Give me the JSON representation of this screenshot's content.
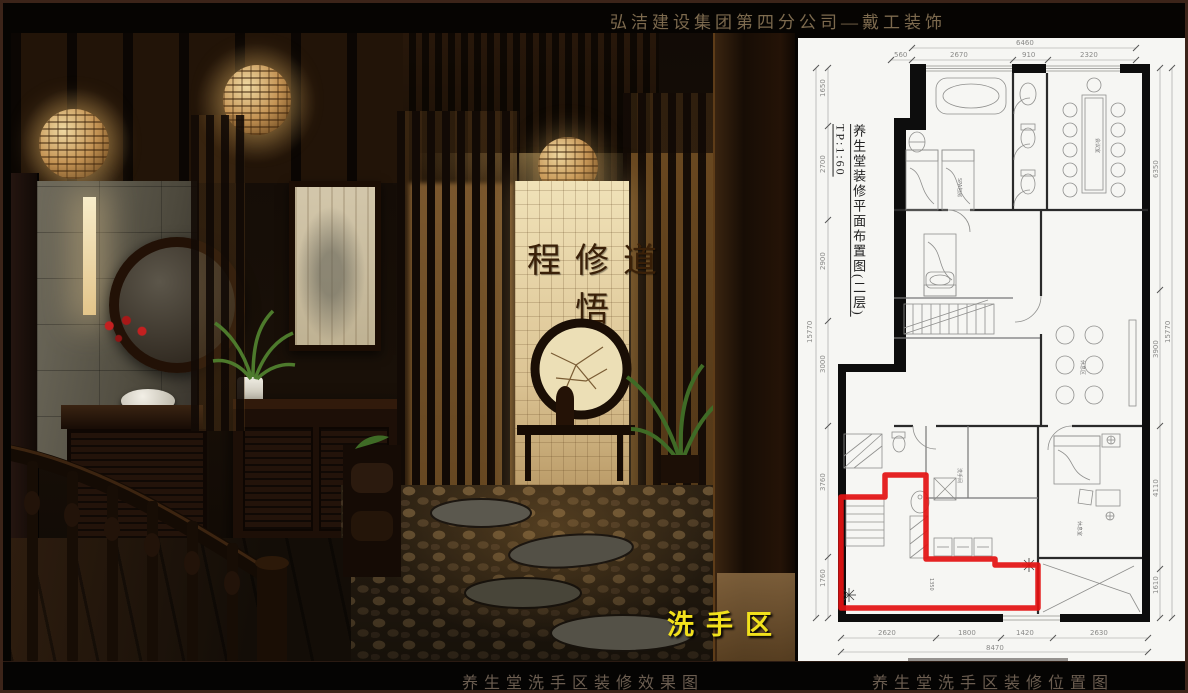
{
  "header": {
    "title": "弘洁建设集团第四分公司—戴工装饰"
  },
  "footer": {
    "left_caption": "养生堂洗手区装修效果图",
    "right_caption": "养生堂洗手区装修位置图"
  },
  "photo": {
    "highlight_label": "洗手区",
    "calligraphy": "程修道悟"
  },
  "plan": {
    "title_vertical": "养生堂装修平面布置图(二层)",
    "scale": "TP:1:60",
    "dims": {
      "top": {
        "overall": "6460",
        "segments": [
          "560",
          "2670",
          "910",
          "2320"
        ]
      },
      "bottom": {
        "overall": "8470",
        "segments": [
          "2620",
          "1800",
          "1420",
          "2630"
        ]
      },
      "left": {
        "overall": "15770",
        "segments": [
          "1650",
          "2700",
          "2900",
          "3000",
          "3760",
          "1760"
        ]
      },
      "right": {
        "overall": "15770",
        "segments": [
          "6350",
          "3900",
          "4110",
          "1610"
        ]
      }
    },
    "room_labels": [
      "SPA包房",
      "会议室",
      "休息区",
      "休息室",
      "洗手间"
    ],
    "interior_dim": "1350"
  },
  "colors": {
    "highlight_red": "#e31212",
    "label_yellow": "#f2e11c",
    "title_gold": "#7d6a4e",
    "plan_background": "#f6f6f3"
  }
}
